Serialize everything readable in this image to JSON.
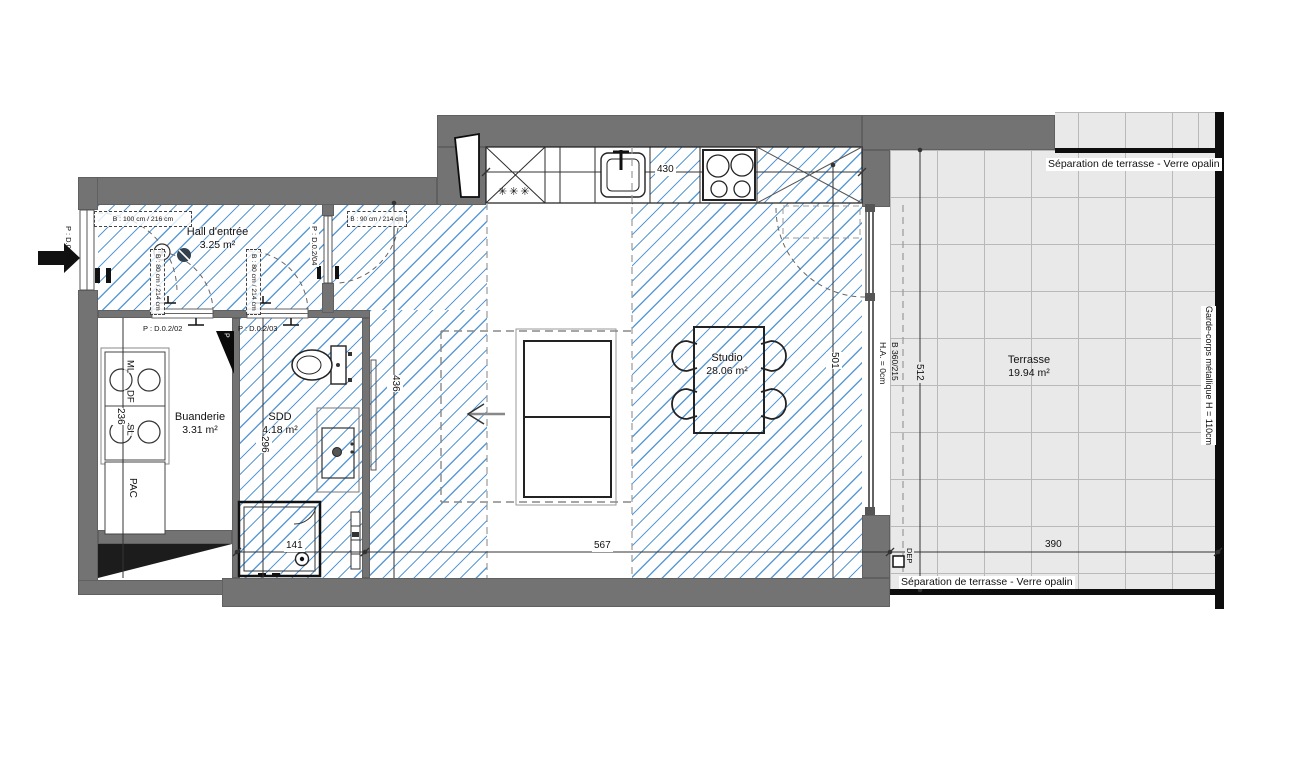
{
  "rooms": {
    "hall": {
      "name": "Hall d'entrée",
      "area": "3.25 m²"
    },
    "buanderie": {
      "name": "Buanderie",
      "area": "3.31 m²"
    },
    "sdd": {
      "name": "SDD",
      "area": "4.18 m²"
    },
    "studio": {
      "name": "Studio",
      "area": "28.06 m²"
    },
    "terrasse": {
      "name": "Terrasse",
      "area": "19.94 m²"
    }
  },
  "doors": {
    "entry": "P : D.0.2/01",
    "buanderie": "P : D.0.2/02",
    "sdd": "P : D.0.2/03",
    "studio": "P : D.0.2/04"
  },
  "windows": {
    "hall_window_100": "B : 100 cm / 216 cm",
    "hall_window_90": "B : 90 cm / 214 cm",
    "door_b80_left": "B : 80 cm / 214 cm",
    "door_b80_right": "B : 80 cm / 214 cm",
    "bay_type": "B 360/215",
    "bay_height": "H.A. = 0cm"
  },
  "dimensions": {
    "kitchen_430": "430",
    "shower_141": "141",
    "studio_567": "567",
    "terrasse_390": "390",
    "buanderie_236": "236",
    "sdd_296": "296",
    "corridor_436": "436",
    "studio_501": "501",
    "terrasse_512": "512"
  },
  "annotations": {
    "separation_top": "Séparation de terrasse - Verre opalin",
    "separation_bottom": "Séparation de terrasse - Verre opalin",
    "garde_corps": "Garde-corps métallique H = 110cm",
    "dep": "DEP",
    "pac": "PAC",
    "ml": "ML",
    "df": "DF",
    "sl": "SL",
    "slope": "P",
    "fridge_symbol": "✳✳✳"
  },
  "colors": {
    "wall": "#737373",
    "hatch_blue": "#5b9bd5",
    "terrace_bg": "#e9e9e9",
    "terrace_grid": "#b9b9b9"
  }
}
